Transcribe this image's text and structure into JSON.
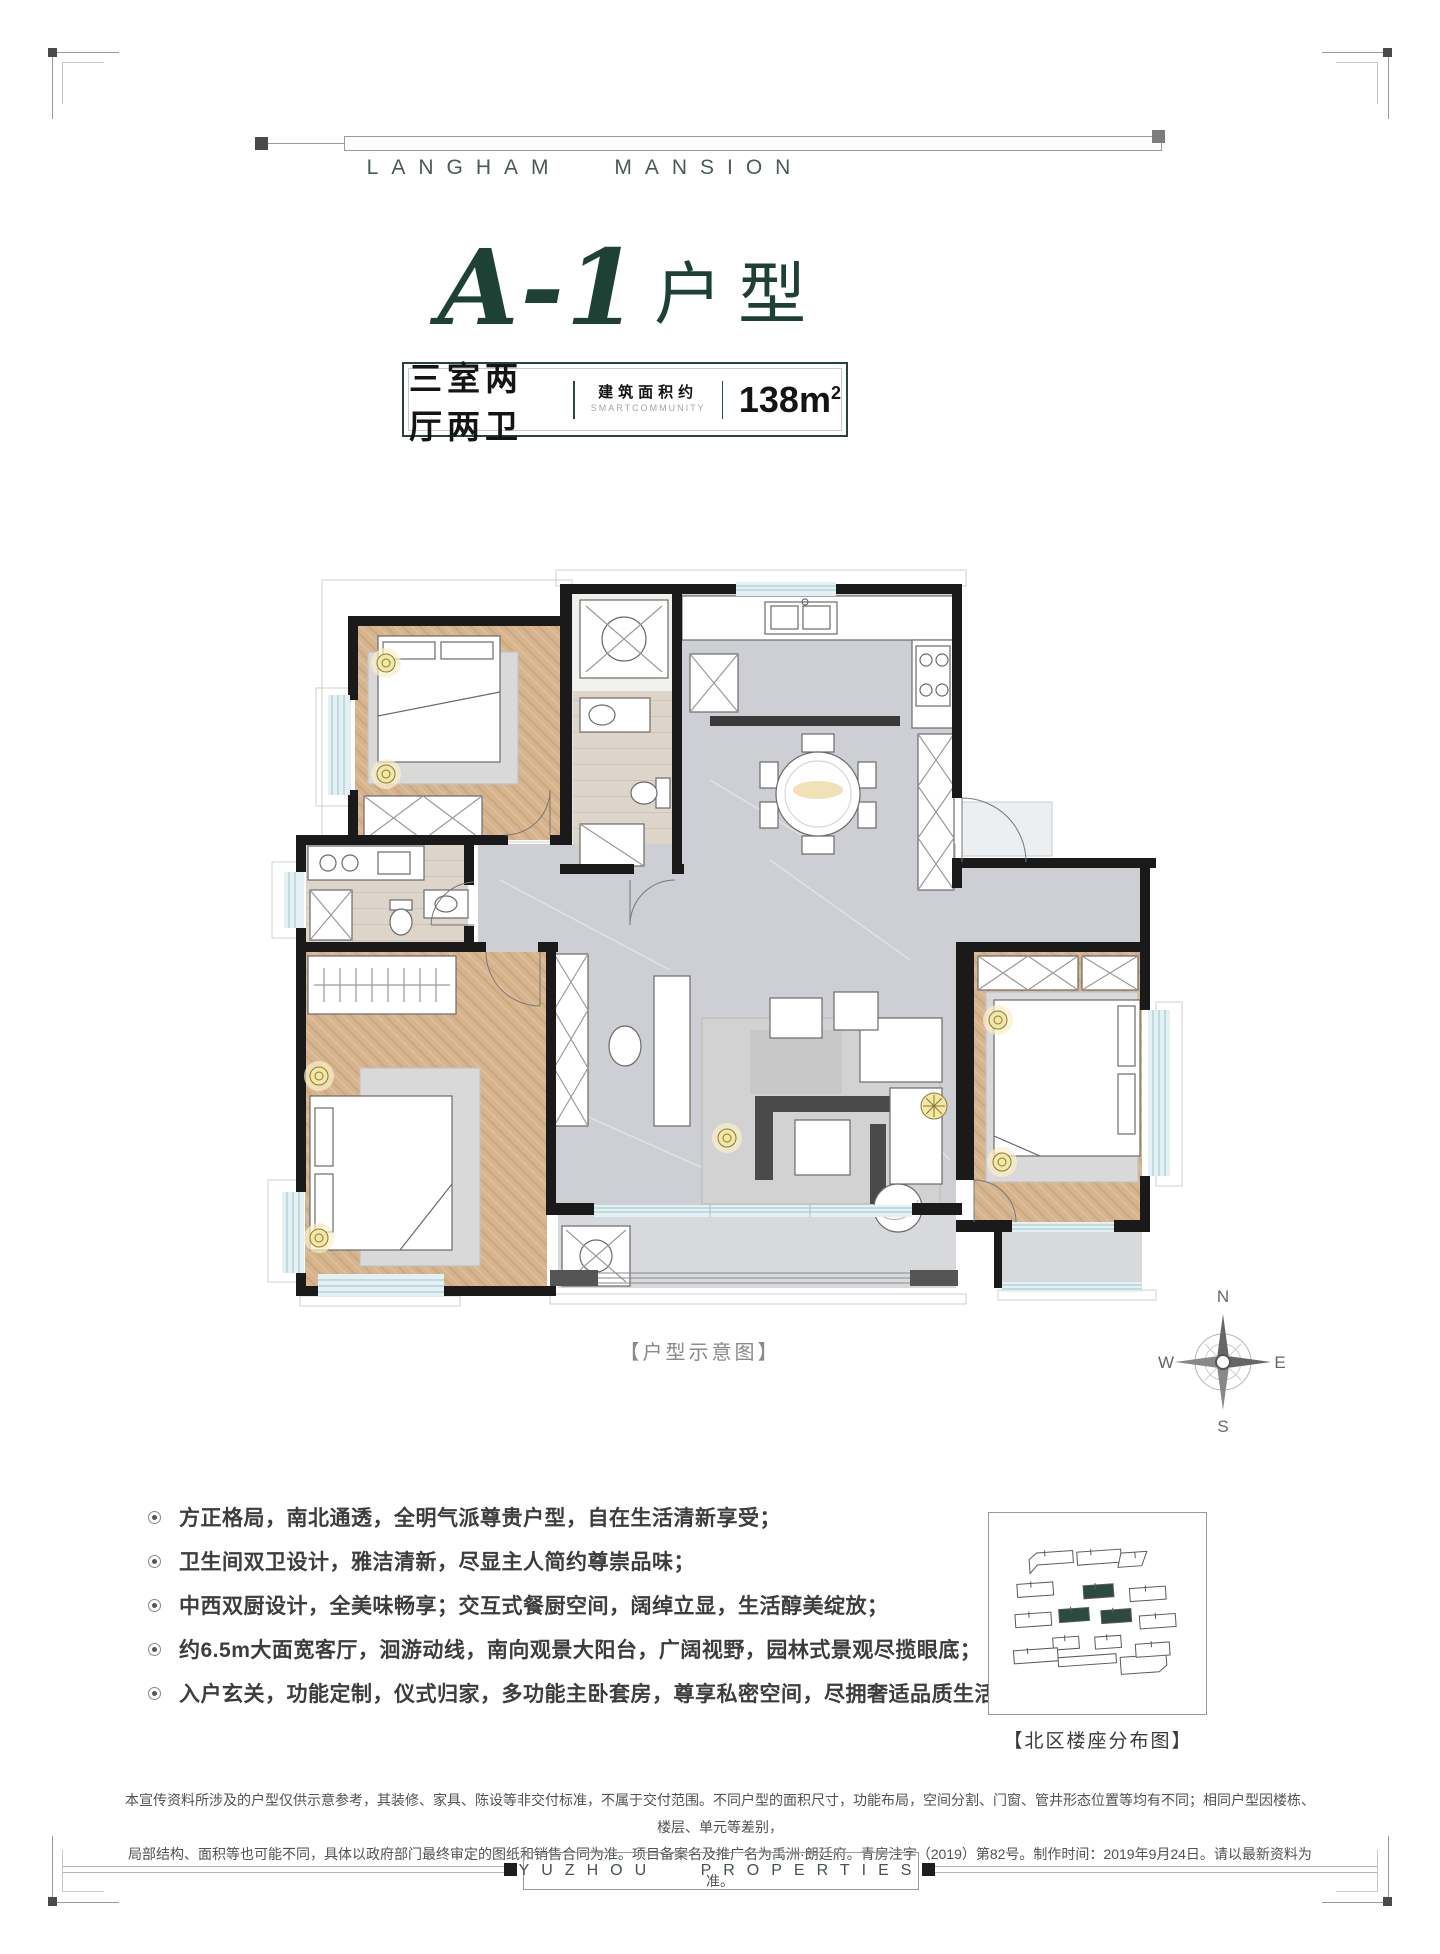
{
  "brand": {
    "top_text": "LANGHAM MANSION",
    "footer_text": "YUZHOU PROPERTIES"
  },
  "title": {
    "unit": "A-1",
    "suffix": "户型"
  },
  "spec": {
    "layout": "三室两厅两卫",
    "area_label": "建筑面积约",
    "area_sublabel": "SMARTCOMMUNITY",
    "area_value": "138m",
    "area_sup": "2"
  },
  "plan": {
    "caption": "【户型示意图】",
    "compass": {
      "n": "N",
      "e": "E",
      "s": "S",
      "w": "W"
    }
  },
  "features": {
    "items": [
      "方正格局，南北通透，全明气派尊贵户型，自在生活清新享受；",
      "卫生间双卫设计，雅洁清新，尽显主人简约尊崇品味；",
      "中西双厨设计，全美味畅享；交互式餐厨空间，阔绰立显，生活醇美绽放；",
      "约6.5m大面宽客厅，洄游动线，南向观景大阳台，广阔视野，园林式景观尽揽眼底；",
      "入户玄关，功能定制，仪式归家，多功能主卧套房，尊享私密空间，尽拥奢适品质生活。"
    ]
  },
  "sitemap": {
    "caption": "【北区楼座分布图】"
  },
  "disclaimer": {
    "line1": "本宣传资料所涉及的户型仅供示意参考，其装修、家具、陈设等非交付标准，不属于交付范围。不同户型的面积尺寸，功能布局，空间分割、门窗、管井形态位置等均有不同；相同户型因楼栋、楼层、单元等差别，",
    "line2": "局部结构、面积等也可能不同，具体以政府部门最终审定的图纸和销售合同为准。项目备案名及推广名为禹洲·朗廷府。青房注字（2019）第82号。制作时间：2019年9月24日。请以最新资料为准。"
  },
  "colors": {
    "accent_green": "#24453a",
    "title_green": "#1d4134",
    "wall_black": "#1a1a1a",
    "wood": "#d6b48e",
    "marble": "#cdcfd4",
    "window_blue": "#e3f0f4"
  }
}
